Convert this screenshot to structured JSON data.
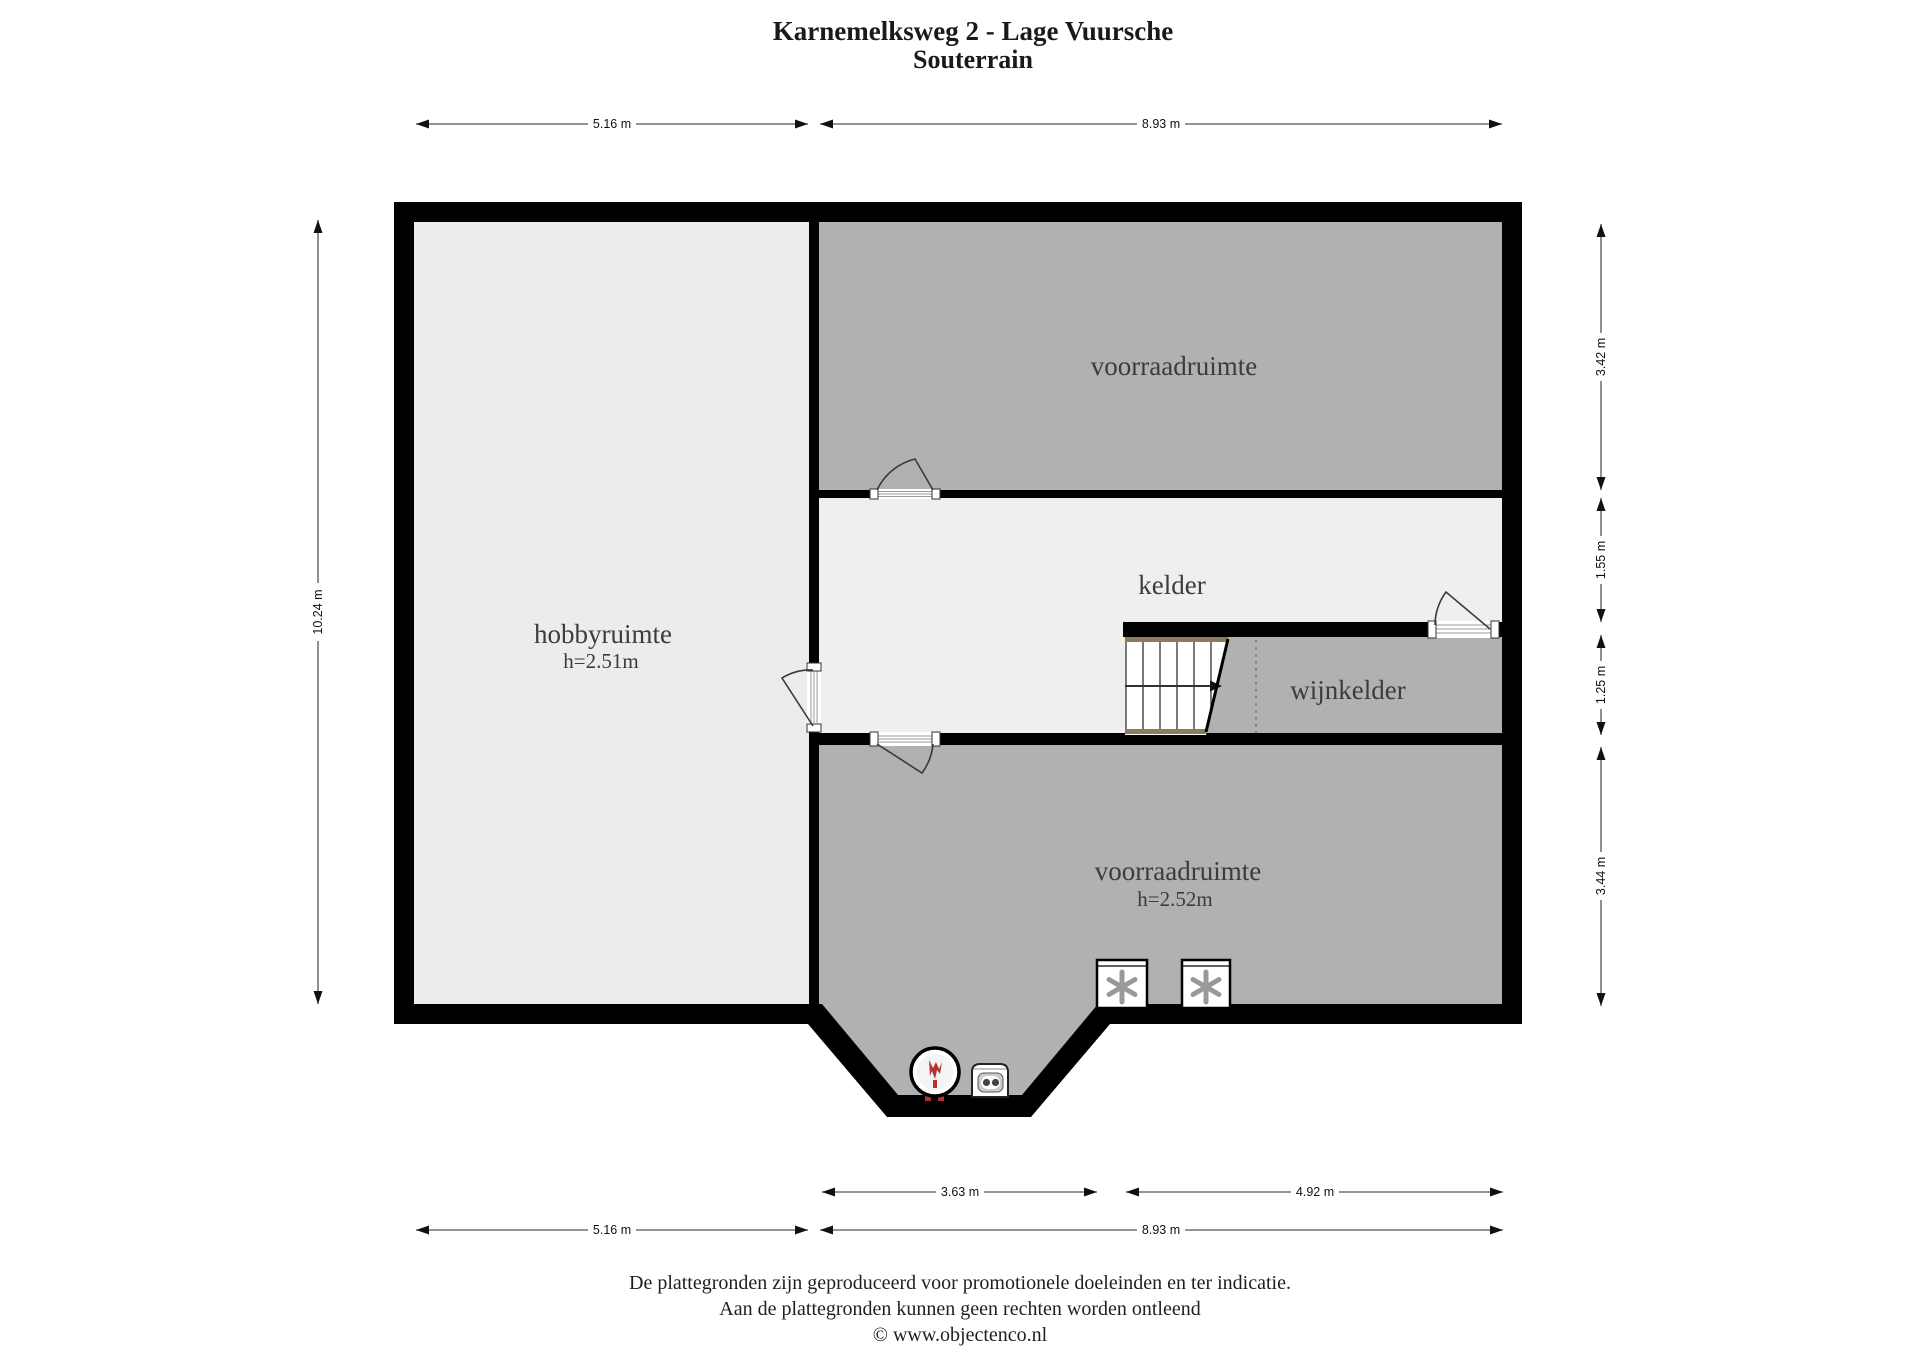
{
  "title": {
    "line1": "Karnemelksweg 2 - Lage Vuursche",
    "line2": "Souterrain"
  },
  "rooms": {
    "hobbyruimte": {
      "name": "hobbyruimte",
      "height_label": "h=2.51m"
    },
    "voorraadruimte_top": {
      "name": "voorraadruimte"
    },
    "kelder": {
      "name": "kelder"
    },
    "wijnkelder": {
      "name": "wijnkelder"
    },
    "voorraadruimte_bottom": {
      "name": "voorraadruimte",
      "height_label": "h=2.52m"
    }
  },
  "dimensions": {
    "top": [
      {
        "label": "5.16 m"
      },
      {
        "label": "8.93 m"
      }
    ],
    "left": [
      {
        "label": "10.24 m"
      }
    ],
    "right": [
      {
        "label": "3.42 m"
      },
      {
        "label": "1.55 m"
      },
      {
        "label": "1.25 m"
      },
      {
        "label": "3.44 m"
      }
    ],
    "bottom_inner": [
      {
        "label": "3.63 m"
      },
      {
        "label": "4.92 m"
      }
    ],
    "bottom_outer": [
      {
        "label": "5.16 m"
      },
      {
        "label": "8.93 m"
      }
    ]
  },
  "footer": {
    "line1": "De plattegronden zijn geproduceerd voor promotionele doeleinden en ter indicatie.",
    "line2": "Aan de plattegronden kunnen geen rechten worden ontleend",
    "line3": "© www.objectenco.nl"
  },
  "icons": {
    "freezer_icon": "✳",
    "boiler_icon": "flame",
    "stairs_icon": "stairs-up-arrow"
  },
  "colors": {
    "wall": "#000000",
    "room_gray": "#b1b1b1",
    "room_light": "#ececec",
    "kelder_light": "#efefef",
    "stair_wood": "#8c7b5c",
    "flame_red": "#b63232",
    "asterisk_gray": "#999999"
  }
}
